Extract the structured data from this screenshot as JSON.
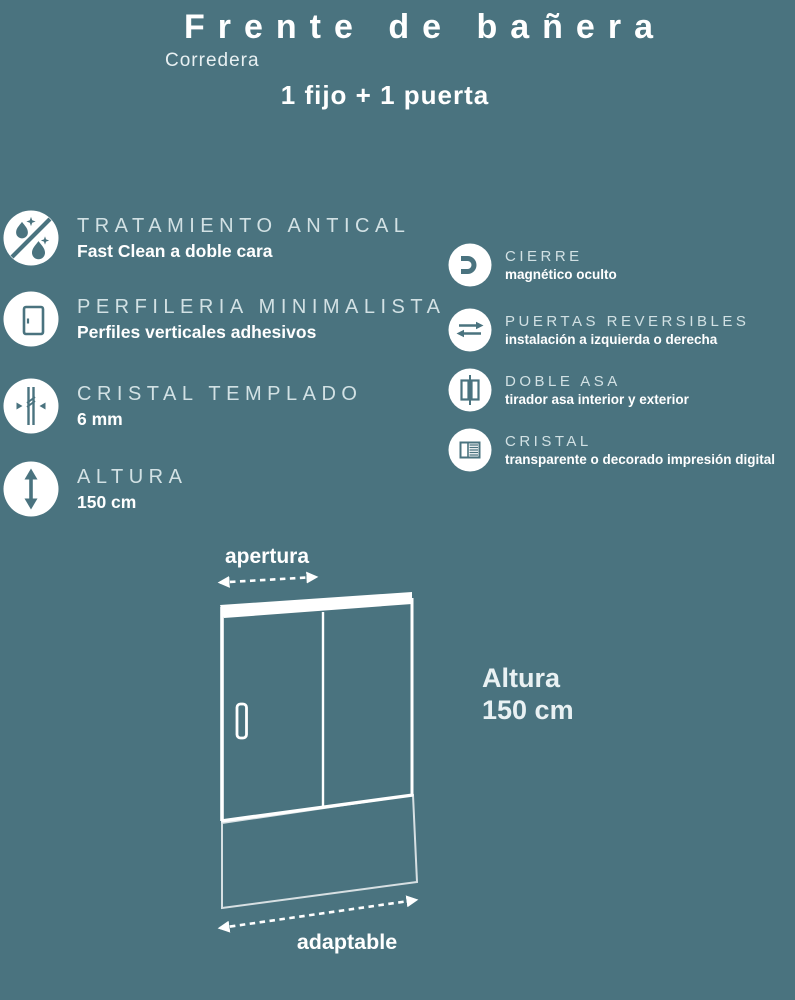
{
  "colors": {
    "background": "#4A737F",
    "icon_circle": "#FFFFFF",
    "icon_glyph": "#4A737F",
    "title_text": "#FFFFFF",
    "caps_text": "#D2E1E4"
  },
  "header": {
    "title": "Frente de bañera",
    "subtitle": "Corredera",
    "configuration": "1 fijo + 1 puerta"
  },
  "features_left": [
    {
      "icon": "anti-limescale-icon",
      "title": "TRATAMIENTO ANTICAL",
      "subtitle": "Fast Clean a doble cara"
    },
    {
      "icon": "minimal-profile-door-icon",
      "title": "PERFILERIA MINIMALISTA",
      "subtitle": "Perfiles verticales adhesivos"
    },
    {
      "icon": "tempered-glass-icon",
      "title": "CRISTAL TEMPLADO",
      "subtitle": "6 mm"
    },
    {
      "icon": "height-arrow-icon",
      "title": "ALTURA",
      "subtitle": "150 cm"
    }
  ],
  "features_right": [
    {
      "icon": "magnet-icon",
      "title": "CIERRE",
      "subtitle": "magnético oculto"
    },
    {
      "icon": "reversible-arrows-icon",
      "title": "PUERTAS REVERSIBLES",
      "subtitle": "instalación a izquierda o derecha"
    },
    {
      "icon": "double-handle-icon",
      "title": "DOBLE ASA",
      "subtitle": "tirador asa interior y exterior"
    },
    {
      "icon": "glass-finish-icon",
      "title": "CRISTAL",
      "subtitle": "transparente o decorado impresión digital"
    }
  ],
  "diagram": {
    "top_label": "apertura",
    "bottom_label": "adaptable",
    "height_label_line1": "Altura",
    "height_label_line2": "150 cm"
  }
}
